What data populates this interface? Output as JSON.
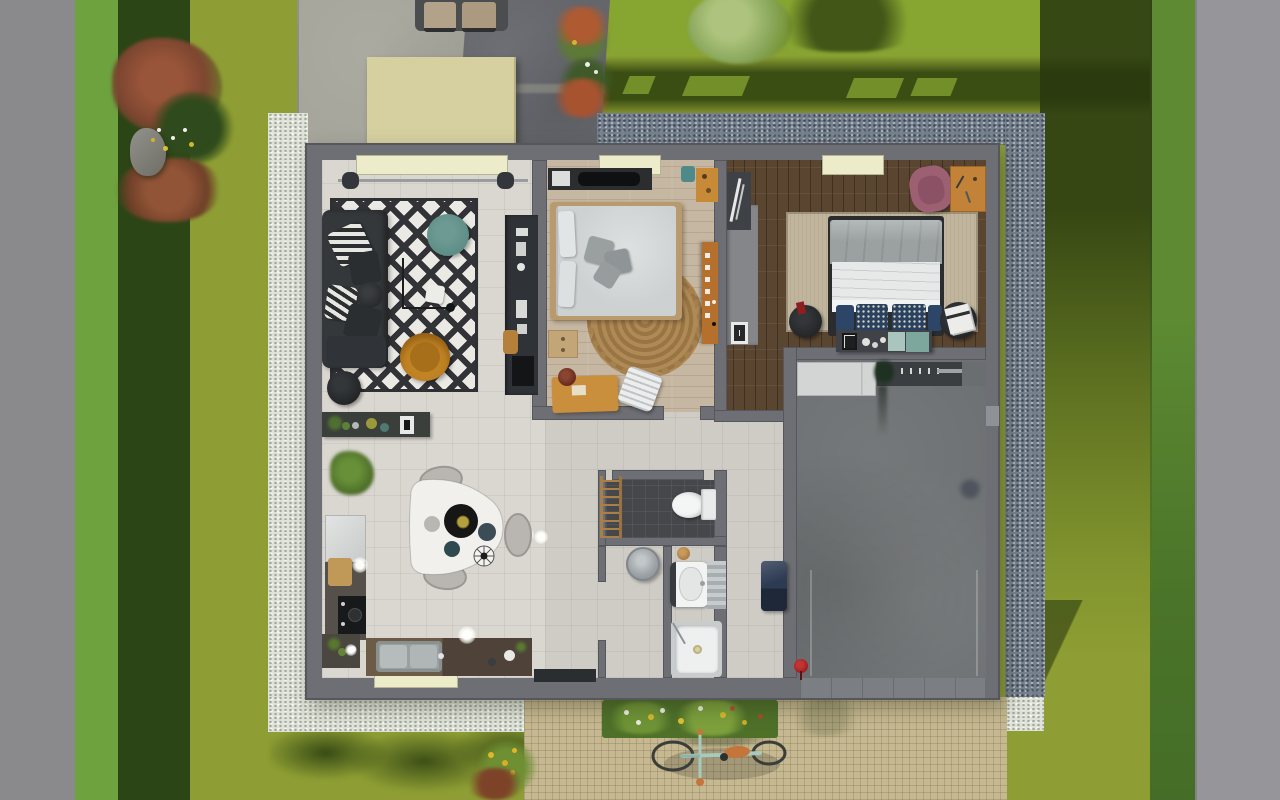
{
  "scene": {
    "type": "3d_floorplan_top_view_render",
    "rooms": [
      "living-room",
      "dining-kitchen",
      "bedroom-1",
      "bedroom-2",
      "garage",
      "bathroom",
      "wc",
      "hallway",
      "utility"
    ],
    "garden": [
      "left-road",
      "left-hedge",
      "lawn",
      "right-hedge",
      "right-road",
      "white-gravel-border",
      "blue-gravel-border",
      "paver-path",
      "flower-bed",
      "bicycle",
      "patio",
      "shed",
      "car",
      "rock",
      "shrubs"
    ]
  },
  "palette": {
    "road_left": "#8a8a8c",
    "road_right": "#95959a",
    "hedge_bright": "#6da23f",
    "hedge_dark": "#2c4517",
    "hedge_right": "#5d8a33",
    "lawn": "#8e9e34",
    "lawn_light": "#87a531",
    "lawn_shadow": "#2f420e",
    "gravel_white": "#dfe3d9",
    "gravel_blue": "#75808c",
    "patio": "#a6a59b",
    "driveway": "#64666b",
    "shed": "#d6d0a0",
    "wall": "#6d6f75",
    "wall_dark": "#55575d",
    "floor_living": "#dad6d0",
    "floor_tile": "#cfccc6",
    "floor_wood_light": "#c6b7a2",
    "floor_wood_dark": "#5a4530",
    "floor_garage": "#6e7173",
    "floor_wc": "#46474b",
    "rug_white": "#eae9e4",
    "rug_black": "#323337",
    "rug_tan": "#c1b69d",
    "rug_jute": "#ae8a57",
    "sofa": "#35383b",
    "pouf_teal": "#5e8d86",
    "chair_mustard": "#c08424",
    "bed_duvet": "#cdd1d1",
    "bed2_gray": "#9ba1a1",
    "bed2_white": "#e7e9e9",
    "pillow_navy": "#2d4668",
    "chair_pink": "#9d6073",
    "wood_furniture": "#c98f3d",
    "wood_cabinet": "#b5702e",
    "closet_gray": "#84868a",
    "unit_dark": "#2f3236",
    "appliance": "#d3d5d5",
    "hamper_navy": "#2c3a52",
    "red_accent": "#9c1f1f",
    "window_cream": "#ecebca",
    "path_tan": "#c6b890",
    "flowerbed_green": "#4e7029",
    "bike_mint": "#a7cabc",
    "bike_orange": "#c4763a",
    "white": "#f2f3f3",
    "black": "#17181a"
  }
}
